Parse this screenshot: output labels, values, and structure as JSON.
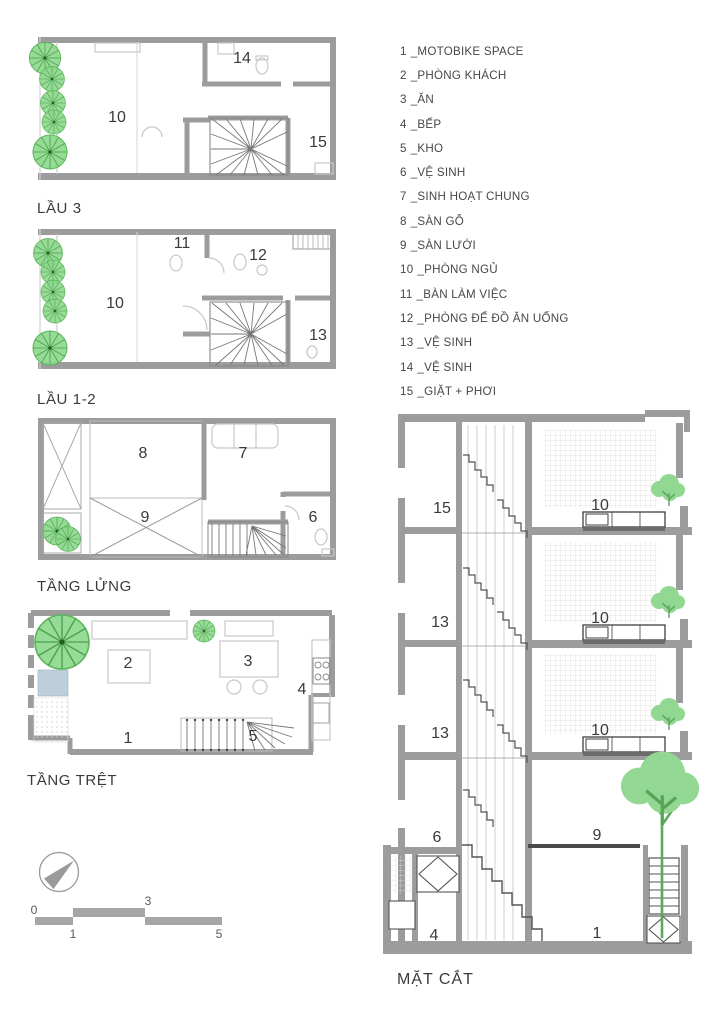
{
  "legend": {
    "separator": "_",
    "items": [
      {
        "num": "1",
        "label": "MOTOBIKE SPACE"
      },
      {
        "num": "2",
        "label": "PHÒNG KHÁCH"
      },
      {
        "num": "3",
        "label": "ĂN"
      },
      {
        "num": "4",
        "label": "BẾP"
      },
      {
        "num": "5",
        "label": "KHO"
      },
      {
        "num": "6",
        "label": "VỆ SINH"
      },
      {
        "num": "7",
        "label": "SINH HOẠT CHUNG"
      },
      {
        "num": "8",
        "label": "SÀN GỖ"
      },
      {
        "num": "9",
        "label": "SÀN LƯỚI"
      },
      {
        "num": "10",
        "label": "PHÒNG NGỦ"
      },
      {
        "num": "11",
        "label": "BÀN LÀM VIỆC"
      },
      {
        "num": "12",
        "label": "PHÒNG ĐỂ ĐỒ ĂN UỐNG"
      },
      {
        "num": "13",
        "label": "VỆ SINH"
      },
      {
        "num": "14",
        "label": "VỆ SINH"
      },
      {
        "num": "15",
        "label": "GIẶT + PHƠI"
      }
    ]
  },
  "plans": {
    "lau3": {
      "title": "LẦU 3",
      "rooms": {
        "r10": "10",
        "r14": "14",
        "r15": "15"
      }
    },
    "lau12": {
      "title": "LẦU 1-2",
      "rooms": {
        "r10": "10",
        "r11": "11",
        "r12": "12",
        "r13": "13"
      }
    },
    "tang_lung": {
      "title": "TẦNG LỬNG",
      "rooms": {
        "r8": "8",
        "r9": "9",
        "r7": "7",
        "r6": "6"
      }
    },
    "tang_tret": {
      "title": "TẦNG TRỆT",
      "rooms": {
        "r1": "1",
        "r2": "2",
        "r3": "3",
        "r4": "4",
        "r5": "5"
      }
    }
  },
  "section": {
    "title": "MẶT CẮT",
    "rooms": {
      "r15": "15",
      "r13a": "13",
      "r13b": "13",
      "r6": "6",
      "r4": "4",
      "r10a": "10",
      "r10b": "10",
      "r10c": "10",
      "r9": "9",
      "r1": "1"
    }
  },
  "scale_bar": {
    "ticks": [
      "0",
      "1",
      "3",
      "5"
    ]
  },
  "colors": {
    "wall": "#9c9c9c",
    "tree": "#8ed88e",
    "water": "#bccfda",
    "text": "#3a3a3a"
  }
}
